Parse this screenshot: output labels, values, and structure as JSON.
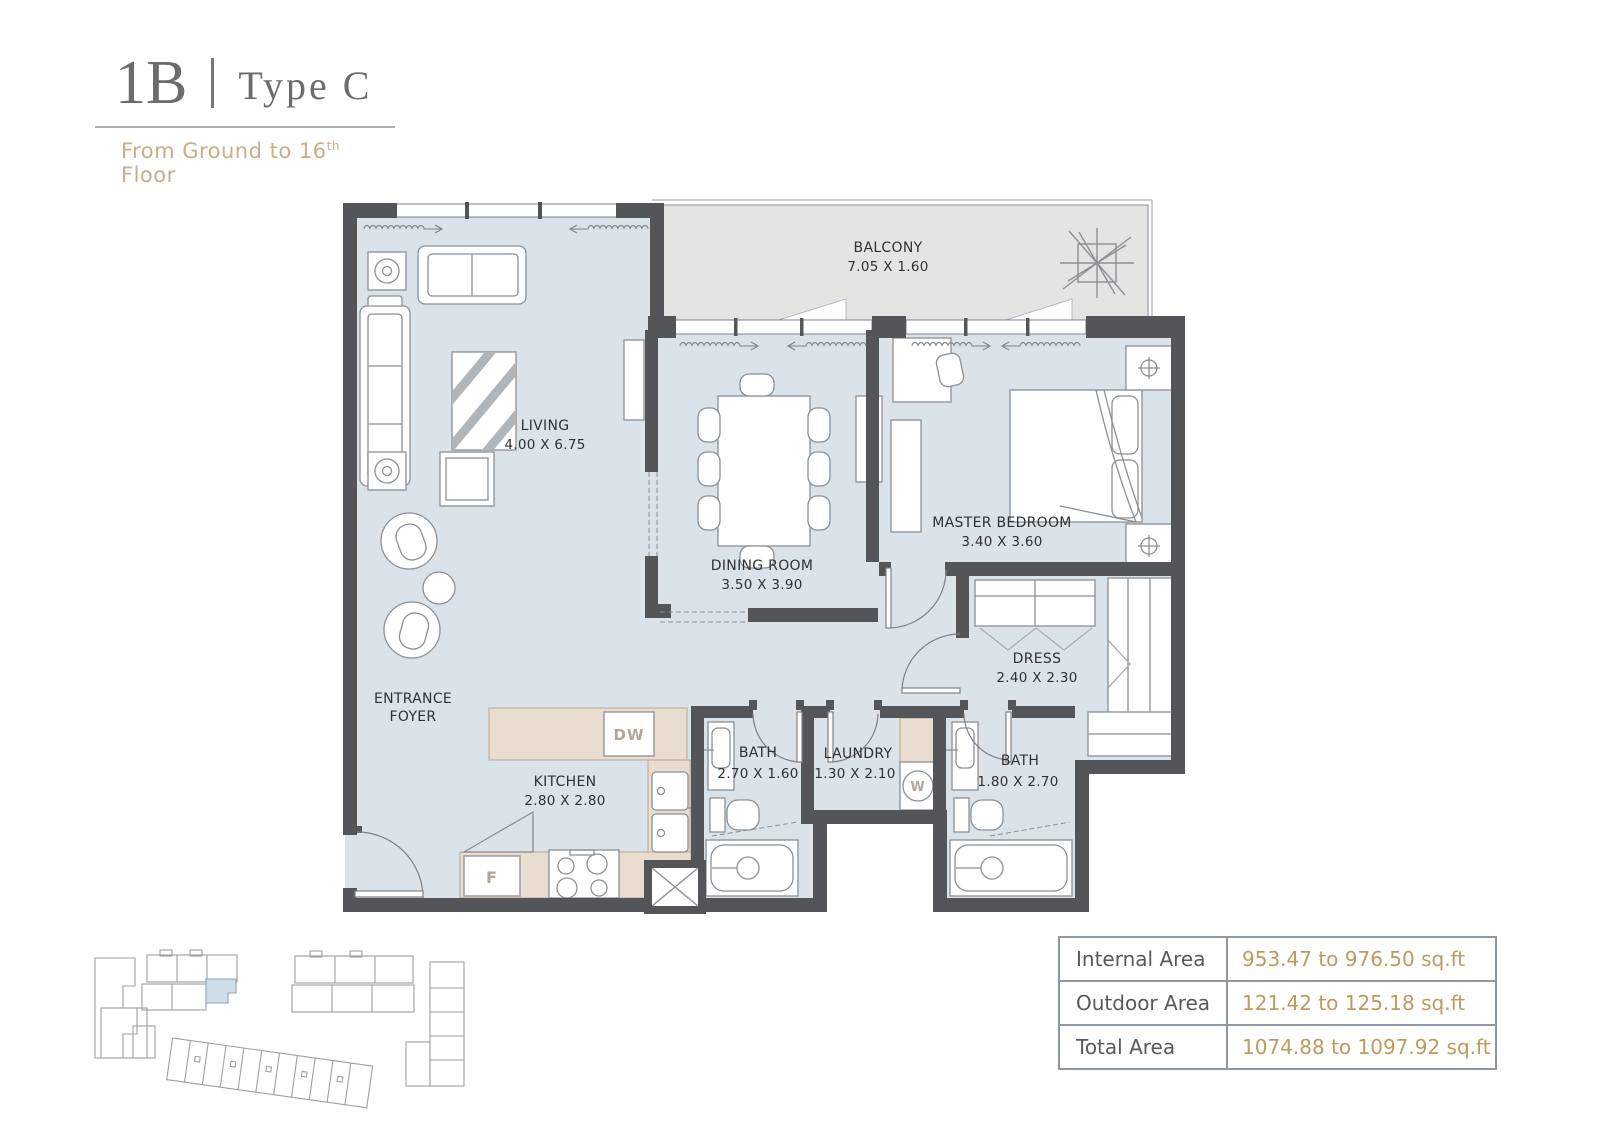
{
  "header": {
    "unit_code": "1B",
    "separator": "|",
    "unit_type": "Type C",
    "floor_range_prefix": "From Ground to 16",
    "floor_range_sup": "th",
    "floor_range_suffix": " Floor"
  },
  "rooms": {
    "balcony": {
      "name": "BALCONY",
      "dims": "7.05 X 1.60"
    },
    "living": {
      "name": "LIVING",
      "dims": "4.00 X 6.75"
    },
    "dining": {
      "name": "DINING ROOM",
      "dims": "3.50 X 3.90"
    },
    "master_bedroom": {
      "name": "MASTER BEDROOM",
      "dims": "3.40 X 3.60"
    },
    "dress": {
      "name": "DRESS",
      "dims": "2.40 X 2.30"
    },
    "entrance_foyer": {
      "line1": "ENTRANCE",
      "line2": "FOYER"
    },
    "kitchen": {
      "name": "KITCHEN",
      "dims": "2.80 X 2.80"
    },
    "bath_small": {
      "name": "BATH",
      "dims": "2.70 X 1.60"
    },
    "laundry": {
      "name": "LAUNDRY",
      "dims": "1.30 X 2.10"
    },
    "bath_master": {
      "name": "BATH",
      "dims": "1.80 X 2.70"
    }
  },
  "appliances": {
    "dishwasher": "DW",
    "fridge": "F",
    "washer": "W"
  },
  "area_table": {
    "rows": [
      {
        "label": "Internal Area",
        "value": "953.47 to 976.50 sq.ft"
      },
      {
        "label": "Outdoor Area",
        "value": "121.42 to 125.18 sq.ft"
      },
      {
        "label": "Total Area",
        "value": "1074.88 to 1097.92 sq.ft"
      }
    ]
  },
  "colors": {
    "accent_gold": "#bf9a5c",
    "title_gray": "#6b6c6e",
    "subtitle_tan": "#c7ae8b",
    "room_fill": "#dbe3ea",
    "balcony_fill": "#e4e4e3",
    "wall": "#545559",
    "counter_fill": "#e9ddd0",
    "table_border": "#8d98a1",
    "site_highlight": "#cddee9"
  }
}
